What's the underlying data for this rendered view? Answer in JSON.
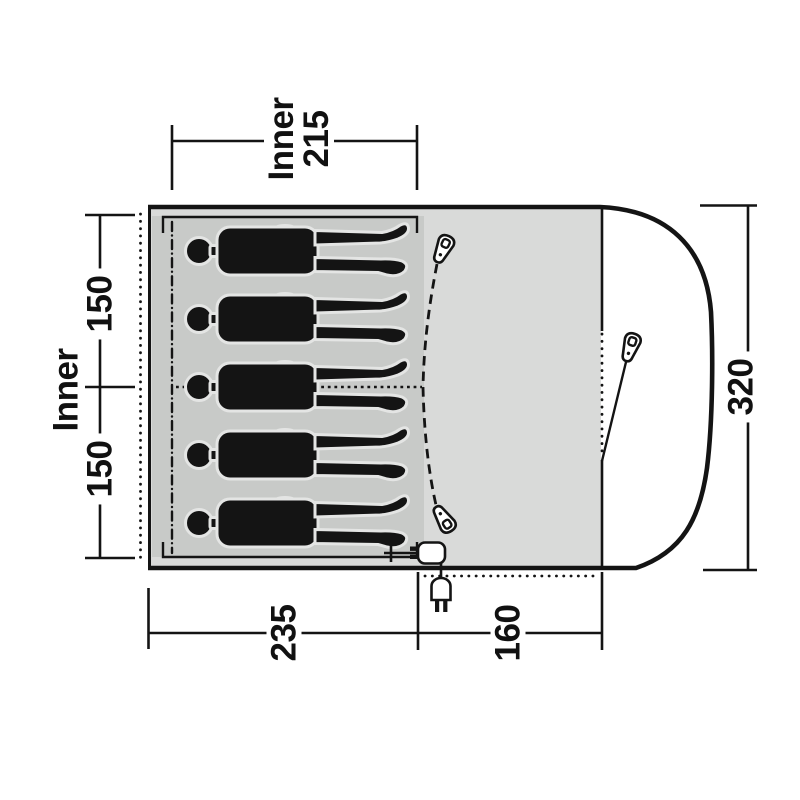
{
  "diagram": {
    "type": "tent-floorplan",
    "labels": {
      "top_width": {
        "line1": "Inner",
        "line2": "215"
      },
      "left_outer": "Inner",
      "left_section_top": "150",
      "left_section_bottom": "150",
      "right_height": "320",
      "bottom_inner_width": "235",
      "bottom_porch_width": "160"
    },
    "occupants": {
      "count": 5
    },
    "icons": {
      "zipper_pulls": 3,
      "power_plug": 1
    },
    "colors": {
      "background": "#ffffff",
      "inner_area": "#c8cac8",
      "porch_area": "#d9dad9",
      "line": "#141414",
      "halo": "#e4e5e4"
    }
  }
}
